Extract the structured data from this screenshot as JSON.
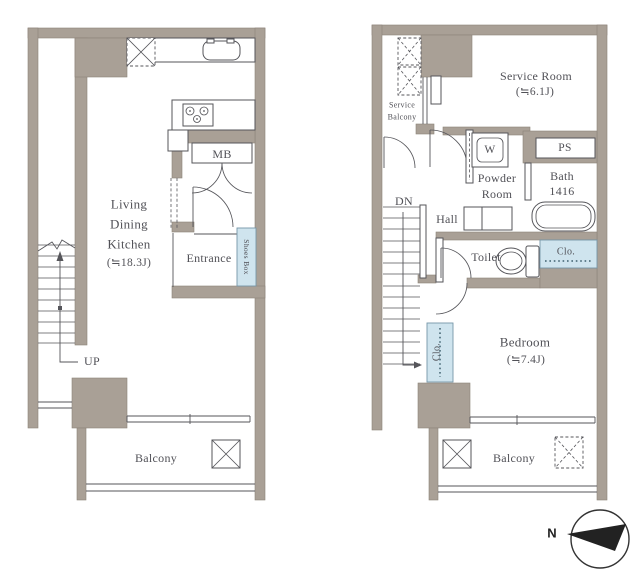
{
  "colors": {
    "background": "#ffffff",
    "wall": "#a9a096",
    "line": "#55555a",
    "text": "#515157",
    "closet_fill": "#cfe4ee",
    "closet_stroke": "#7696a8",
    "north_arrow": "#222222"
  },
  "floor1": {
    "labels": {
      "living1": "Living",
      "living2": "Dining",
      "living3": "Kitchen",
      "living_size": "(≒18.3J)",
      "mb": "MB",
      "entrance": "Entrance",
      "shoes_box": "Shoes Box",
      "up": "UP",
      "balcony": "Balcony"
    }
  },
  "floor2": {
    "labels": {
      "service_balcony1": "Service",
      "service_balcony2": "Balcony",
      "service_room": "Service Room",
      "service_room_size": "(≒6.1J)",
      "washer": "W",
      "ps": "PS",
      "powder1": "Powder",
      "powder2": "Room",
      "bath": "Bath",
      "bath_size": "1416",
      "dn": "DN",
      "hall": "Hall",
      "toilet": "Toilet",
      "closet_bedroom": "Clo.",
      "closet_hall": "Clo.",
      "bedroom": "Bedroom",
      "bedroom_size": "(≒7.4J)",
      "balcony": "Balcony"
    }
  },
  "compass": {
    "north_label": "N"
  }
}
